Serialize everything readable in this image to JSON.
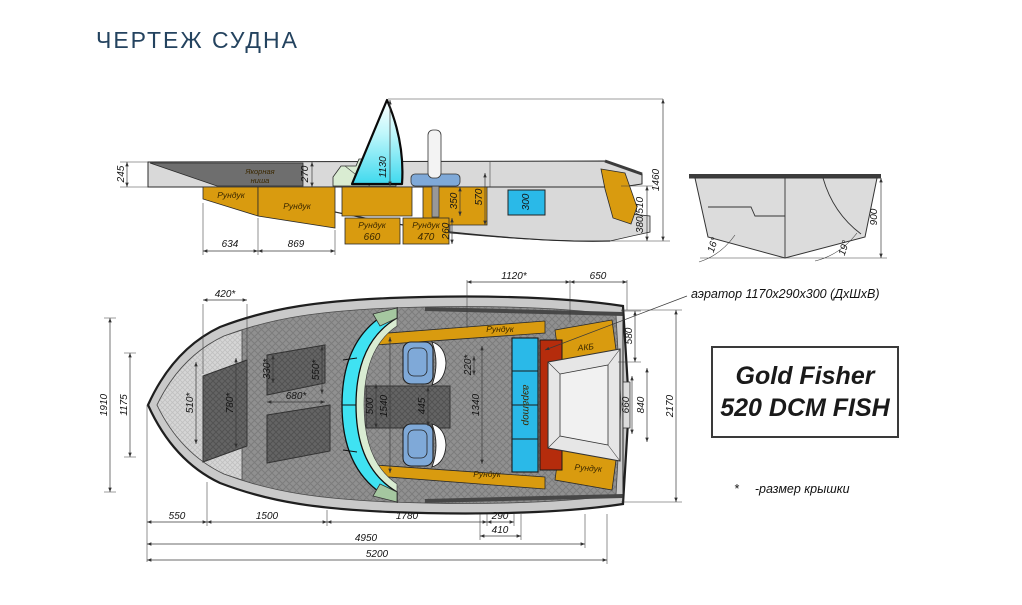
{
  "page": {
    "title": "ЧЕРТЕЖ СУДНА"
  },
  "side_view": {
    "anchor_niche_line1": "Якорная",
    "anchor_niche_line2": "ниша",
    "locker_bow": "Рундук",
    "locker_mid": "Рундук",
    "locker_floor1_name": "Рундук",
    "locker_floor1_size": "660",
    "locker_floor2_name": "Рундук",
    "locker_floor2_size": "470",
    "dims": {
      "bow_sheer": "245",
      "deck_270": "270",
      "windshield_1130": "1130",
      "h350": "350",
      "h570": "570",
      "livewell_300": "300",
      "h260": "260",
      "bow_634": "634",
      "mid_869": "869",
      "overall_1460": "1460",
      "transom_380_510": "380/510"
    }
  },
  "transom_view": {
    "dims": {
      "height_900": "900",
      "deadrise_left": "16°",
      "deadrise_right": "19°"
    }
  },
  "plan_view": {
    "labels": {
      "locker_top": "Рундук",
      "battery": "АКБ",
      "aerator": "аэратор",
      "locker_bottom": "Рундук",
      "locker_stern": "Рундук"
    },
    "dims": {
      "d420": "420*",
      "d1120": "1120*",
      "d650": "650",
      "d1910": "1910",
      "d1175": "1175",
      "d510": "510*",
      "d780": "780*",
      "d330": "330*",
      "d550s": "550*",
      "d680": "680*",
      "d500": "500",
      "d1540": "1540",
      "d445": "445",
      "d220": "220*",
      "d1340": "1340",
      "d580": "580",
      "d660": "660",
      "d840": "840",
      "d2170": "2170",
      "d550": "550",
      "d1500": "1500",
      "d1780": "1780",
      "d290": "290",
      "d410": "410",
      "d4950": "4950",
      "d5200": "5200"
    }
  },
  "model_box": {
    "line1": "Gold Fisher",
    "line2": "520 DCM FISH"
  },
  "annotations": {
    "aerator_note": "аэратор 1170х290х300 (ДхШхВ)",
    "footnote_mark": "*",
    "footnote_text": "-размер крышки"
  },
  "colors": {
    "title": "#24435f",
    "orange": "#d99b0f",
    "cyan_windshield": "#3fe2f2",
    "blue_tank": "#2ab9e8",
    "red_block": "#b52c0c",
    "seat_blue": "#7fa9d8",
    "console_green": "#d9ecd2"
  }
}
